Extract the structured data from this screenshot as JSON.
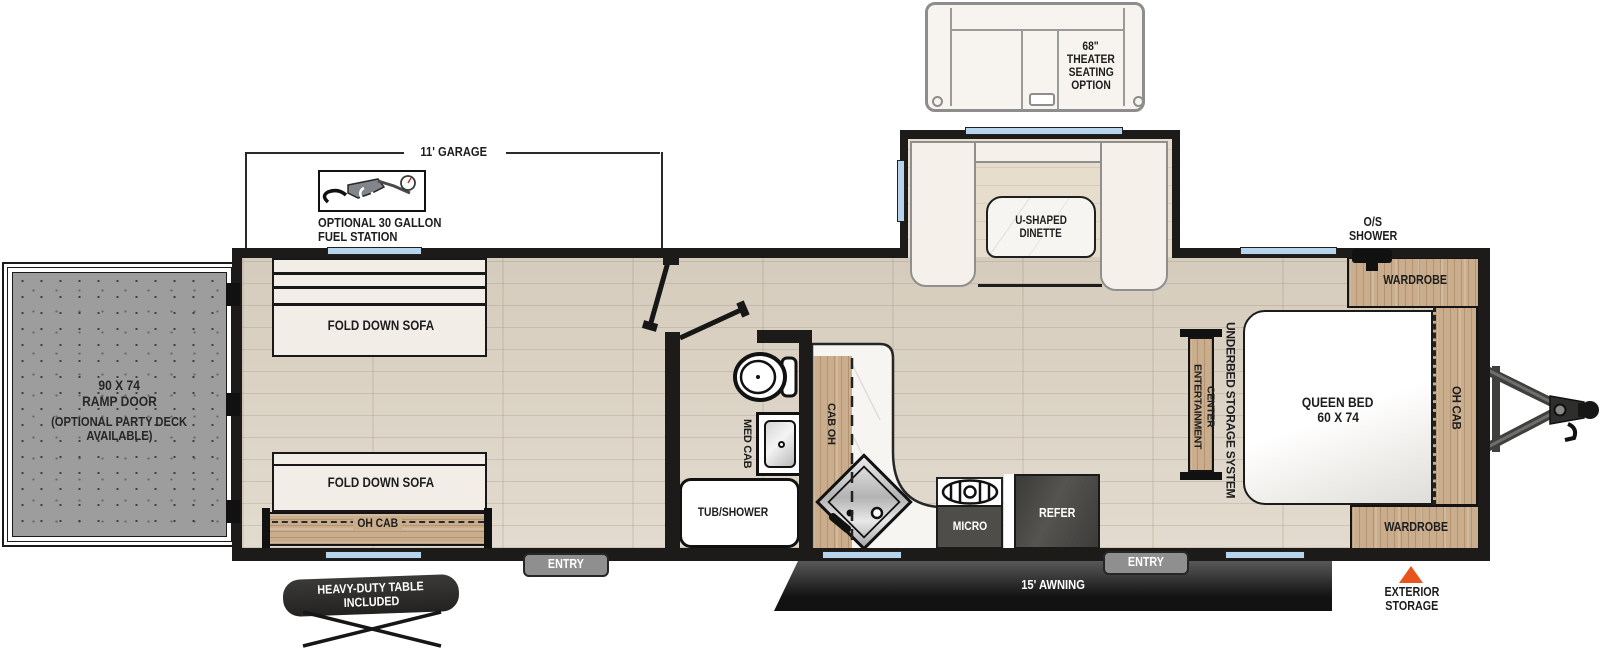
{
  "title": "Toy hauler travel trailer floor plan",
  "colors": {
    "wall": "#1D1B19",
    "accent_orange": "#E8541D",
    "window_blue": "#B8D3EC",
    "wood": "#C9AD8C",
    "bench_cream": "#F5F1EA"
  },
  "exterior": {
    "theater_seating": {
      "line1": "68\"",
      "line2": "THEATER",
      "line3": "SEATING",
      "line4": "OPTION"
    },
    "garage_dimension": "11' GARAGE",
    "fuel_station": {
      "line1": "OPTIONAL 30 GALLON",
      "line2": "FUEL STATION"
    },
    "ramp_door": {
      "line1": "90 X 74",
      "line2": "RAMP DOOR",
      "line3": "(OPTIONAL PARTY DECK",
      "line4": "AVAILABLE)"
    },
    "awning": "15' AWNING",
    "entry_left": "ENTRY",
    "entry_right": "ENTRY",
    "table": {
      "line1": "HEAVY-DUTY TABLE",
      "line2": "INCLUDED"
    },
    "outside_shower": {
      "line1": "O/S",
      "line2": "SHOWER"
    },
    "exterior_storage": {
      "line1": "EXTERIOR",
      "line2": "STORAGE"
    }
  },
  "garage": {
    "sofa_top": "FOLD DOWN SOFA",
    "sofa_bottom": "FOLD DOWN SOFA",
    "overhead_cabinet": "OH CAB"
  },
  "dinette": {
    "line1": "U-SHAPED",
    "line2": "DINETTE"
  },
  "bathroom": {
    "medicine_cabinet": "MED CAB",
    "tub_shower": "TUB/SHOWER"
  },
  "kitchen": {
    "cabinet_overhead": "CAB OH",
    "microwave": "MICRO",
    "refrigerator": "REFER"
  },
  "bedroom": {
    "bed_line1": "QUEEN BED",
    "bed_line2": "60 X 74",
    "wardrobe_top": "WARDROBE",
    "wardrobe_bottom": "WARDROBE",
    "overhead_cabinet": "OH CAB",
    "entertainment_line1": "ENTERTAINMENT",
    "entertainment_line2": "CENTER",
    "underbed_storage": "UNDERBED STORAGE SYSTEM"
  }
}
